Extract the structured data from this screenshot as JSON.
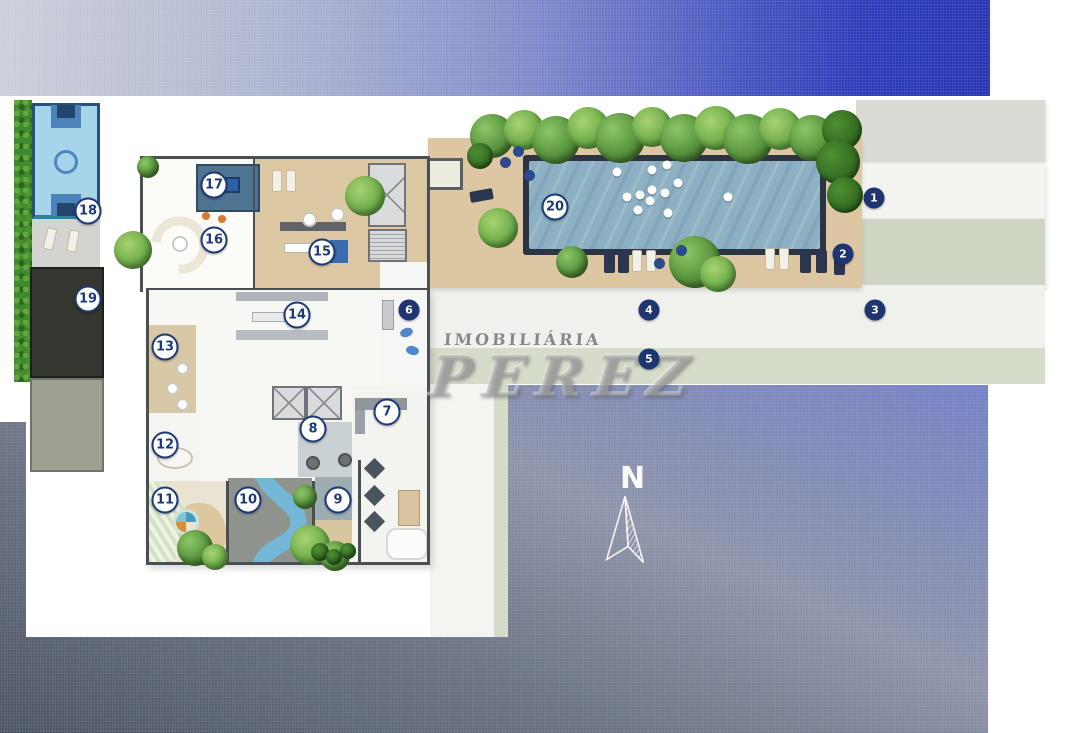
{
  "brand_watermark": {
    "line1": "IMOBILIÁRIA",
    "line2": "PEREZ"
  },
  "compass": {
    "label": "N"
  },
  "markers": [
    {
      "n": 1,
      "x": 874,
      "y": 198,
      "variant": "filled"
    },
    {
      "n": 2,
      "x": 843,
      "y": 254,
      "variant": "filled"
    },
    {
      "n": 3,
      "x": 875,
      "y": 310,
      "variant": "filled"
    },
    {
      "n": 4,
      "x": 649,
      "y": 310,
      "variant": "filled"
    },
    {
      "n": 5,
      "x": 649,
      "y": 359,
      "variant": "filled"
    },
    {
      "n": 6,
      "x": 409,
      "y": 310,
      "variant": "filled"
    },
    {
      "n": 7,
      "x": 387,
      "y": 412,
      "variant": "outline"
    },
    {
      "n": 8,
      "x": 313,
      "y": 429,
      "variant": "outline"
    },
    {
      "n": 9,
      "x": 338,
      "y": 500,
      "variant": "outline"
    },
    {
      "n": 10,
      "x": 248,
      "y": 500,
      "variant": "outline"
    },
    {
      "n": 11,
      "x": 165,
      "y": 500,
      "variant": "outline"
    },
    {
      "n": 12,
      "x": 165,
      "y": 445,
      "variant": "outline"
    },
    {
      "n": 13,
      "x": 165,
      "y": 347,
      "variant": "outline"
    },
    {
      "n": 14,
      "x": 297,
      "y": 315,
      "variant": "outline"
    },
    {
      "n": 15,
      "x": 322,
      "y": 252,
      "variant": "outline"
    },
    {
      "n": 16,
      "x": 214,
      "y": 240,
      "variant": "outline"
    },
    {
      "n": 17,
      "x": 214,
      "y": 185,
      "variant": "outline"
    },
    {
      "n": 18,
      "x": 88,
      "y": 211,
      "variant": "outline"
    },
    {
      "n": 19,
      "x": 88,
      "y": 299,
      "variant": "outline"
    },
    {
      "n": 20,
      "x": 555,
      "y": 207,
      "variant": "outline"
    }
  ],
  "pool": {
    "balls": [
      [
        617,
        172
      ],
      [
        652,
        170
      ],
      [
        667,
        165
      ],
      [
        678,
        183
      ],
      [
        627,
        197
      ],
      [
        640,
        195
      ],
      [
        652,
        190
      ],
      [
        650,
        201
      ],
      [
        665,
        193
      ],
      [
        638,
        210
      ],
      [
        668,
        213
      ],
      [
        728,
        197
      ]
    ]
  },
  "colors": {
    "marker_navy": "#1e3572",
    "sky_blue": "#2230b4",
    "pool_water": "#8db1c3",
    "deck_tan": "#dcc7a2",
    "hedge_green": "#3f8a2f"
  }
}
